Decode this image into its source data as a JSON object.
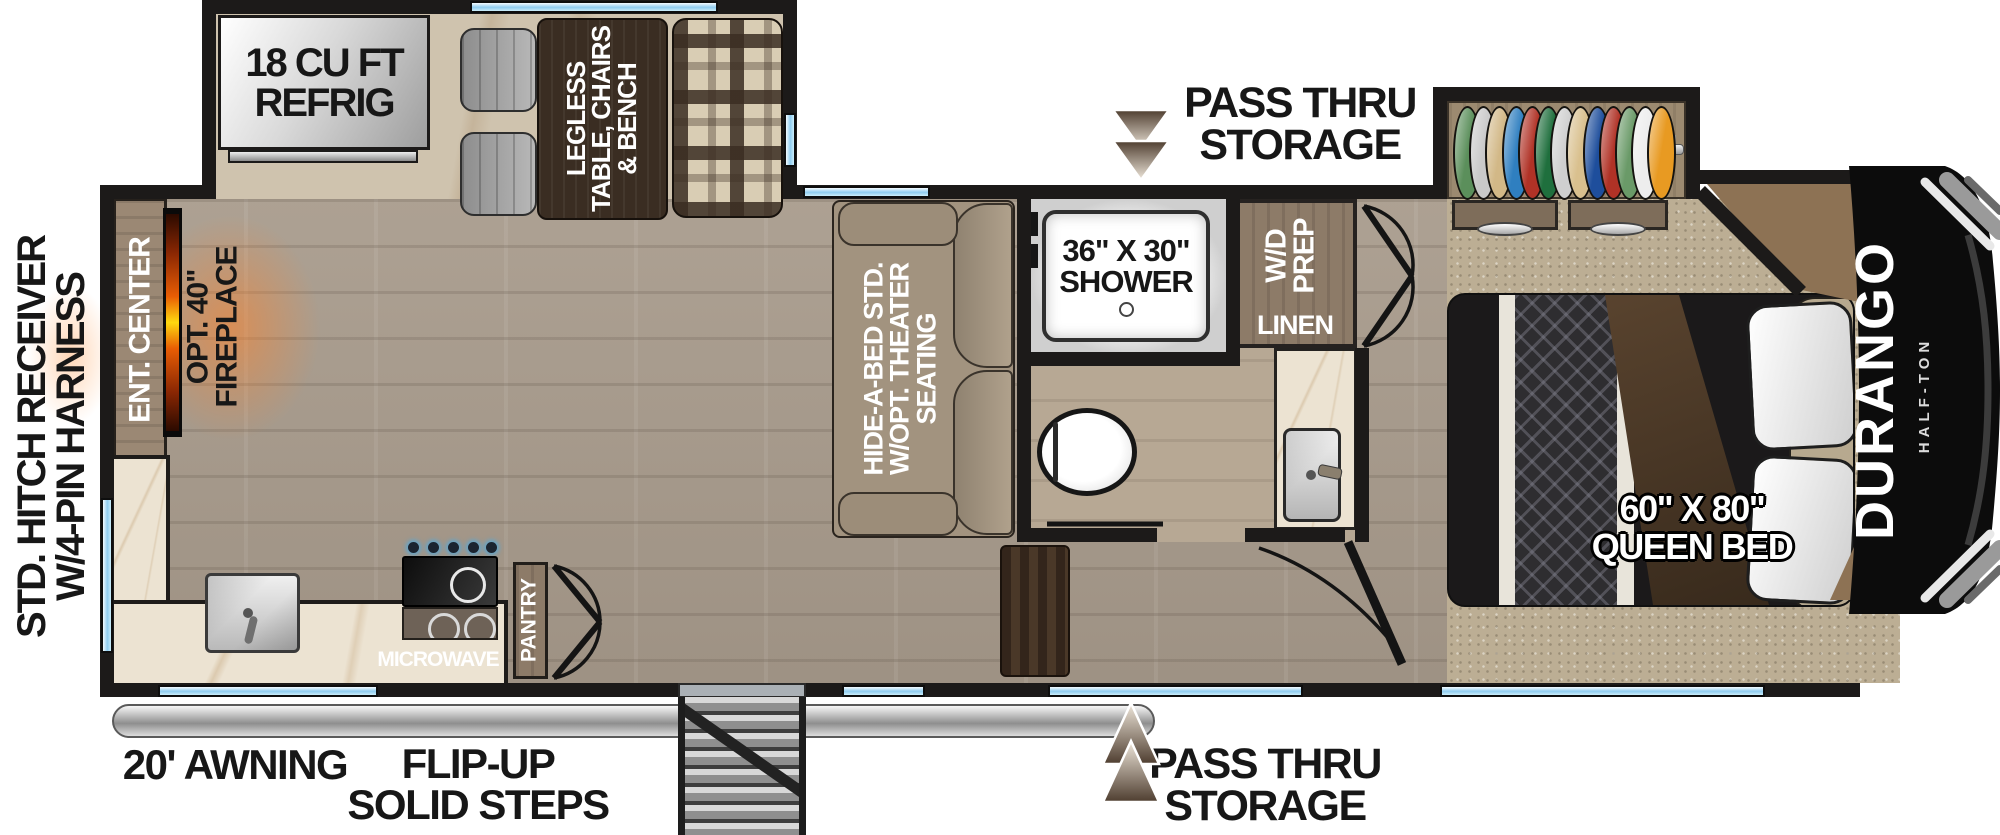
{
  "title": "Fifth wheel RV floor plan",
  "exterior": {
    "hitch_line1": "STD. HITCH RECEIVER",
    "hitch_line2": "W/4-PIN HARNESS",
    "awning": "20' AWNING",
    "steps_line1": "FLIP-UP",
    "steps_line2": "SOLID STEPS",
    "pass_thru_top_line1": "PASS THRU",
    "pass_thru_top_line2": "STORAGE",
    "pass_thru_bottom_line1": "PASS THRU",
    "pass_thru_bottom_line2": "STORAGE",
    "brand": "DURANGO",
    "brand_sub": "HALF-TON"
  },
  "kitchen": {
    "refrig_line1": "18 CU FT",
    "refrig_line2": "REFRIG",
    "microwave": "MICROWAVE",
    "pantry": "PANTRY"
  },
  "living": {
    "dinette_line1": "LEGLESS",
    "dinette_line2": "TABLE, CHAIRS",
    "dinette_line3": "& BENCH",
    "sofa_line1": "HIDE-A-BED STD.",
    "sofa_line2": "W/OPT. THEATER",
    "sofa_line3": "SEATING",
    "ent_center": "ENT. CENTER",
    "fireplace_line1": "OPT. 40\"",
    "fireplace_line2": "FIREPLACE"
  },
  "bath": {
    "shower_line1": "36\" X 30\"",
    "shower_line2": "SHOWER",
    "wd_line1": "W/D",
    "wd_line2": "PREP",
    "linen": "LINEN"
  },
  "bedroom": {
    "bed_line1": "60\" X 80\"",
    "bed_line2": "QUEEN BED"
  },
  "closet": {
    "clothes": [
      "#5b8f5b",
      "#c9c9c9",
      "#d2b887",
      "#2f7fc0",
      "#b03226",
      "#1f6f3d",
      "#cfcfcf",
      "#d9c08e",
      "#1e4e9c",
      "#b03226",
      "#6a9a68",
      "#ededed",
      "#e89a22"
    ]
  },
  "colors": {
    "wall": "#1c1a19",
    "window_blue": "#8fcdf0",
    "floor_main": "#a89b8c",
    "slide_floor": "#cfc3ae",
    "carpet": "#bcae94",
    "cabinet_brown": "#8d7b68",
    "table_dark": "#3a2d22",
    "flame_orange": "#e85d04",
    "cap_black": "#0c0c0c"
  }
}
